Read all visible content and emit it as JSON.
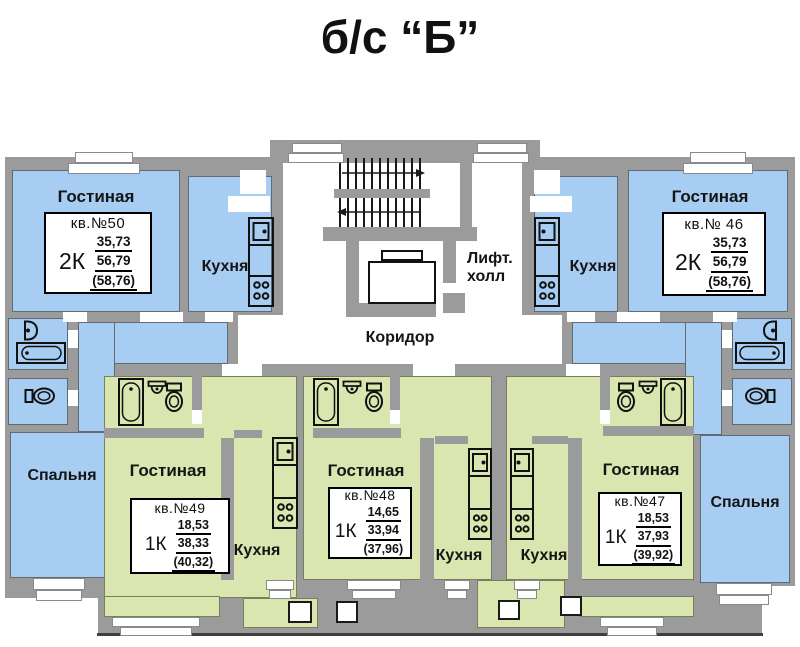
{
  "title": "б/с “Б”",
  "colors": {
    "blue": "#a7cef2",
    "green": "#d9e6af",
    "wall": "#9b9b9b"
  },
  "labels": {
    "living": "Гостиная",
    "kitchen": "Кухня",
    "bedroom": "Спальня",
    "corridor": "Коридор",
    "lift1": "Лифт.",
    "lift2": "холл"
  },
  "apartments": {
    "a50": {
      "kv": "кв.№50",
      "type": "2К",
      "areas": [
        "35,73",
        "56,79",
        "(58,76)"
      ]
    },
    "a46": {
      "kv": "кв.№ 46",
      "type": "2К",
      "areas": [
        "35,73",
        "56,79",
        "(58,76)"
      ]
    },
    "a49": {
      "kv": "кв.№49",
      "type": "1К",
      "areas": [
        "18,53",
        "38,33",
        "(40,32)"
      ]
    },
    "a48": {
      "kv": "кв.№48",
      "type": "1К",
      "areas": [
        "14,65",
        "33,94",
        "(37,96)"
      ]
    },
    "a47": {
      "kv": "кв.№47",
      "type": "1К",
      "areas": [
        "18,53",
        "37,93",
        "(39,92)"
      ]
    }
  }
}
